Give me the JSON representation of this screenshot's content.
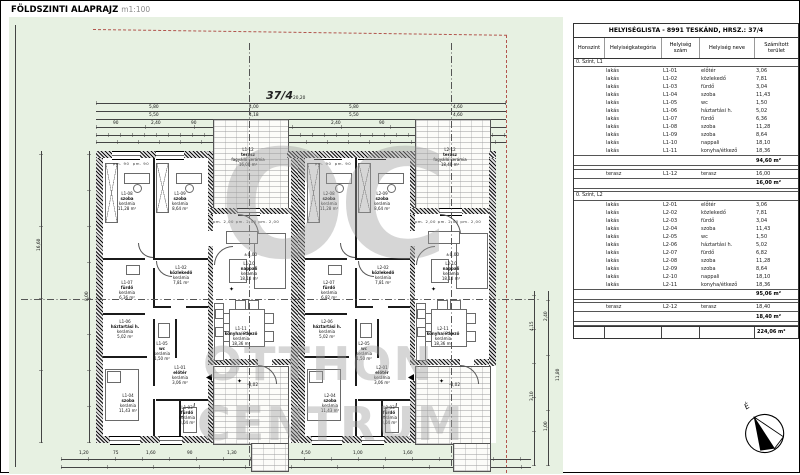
{
  "title": {
    "main": "FÖLDSZINTI ALAPRAJZ",
    "scale": "m1:100"
  },
  "site": {
    "parcel_label": "37/4",
    "north_label": "É",
    "level_zero": "±0,00",
    "level_minus": "-0,02",
    "window_head": "pm. 90",
    "door_head": "pm. 2,00  pm. 2,00  pm. 2,00",
    "colors": {
      "plot_green": "#e7f1e2",
      "boundary_red": "#b2554d"
    }
  },
  "watermark": {
    "initials": "OC",
    "line1": "OTTHON",
    "line2": "CENTRUM"
  },
  "dimensions": {
    "top_total": "20,20",
    "top_row2": [
      "5,80",
      "4,00",
      "5,80",
      "4,60"
    ],
    "top_row3": [
      "5,50",
      "4,18",
      "5,50",
      "4,60"
    ],
    "top_small": [
      "90",
      "2,40",
      "90",
      "2,40",
      "90",
      "1,20"
    ],
    "left": [
      "16,60",
      "8,00"
    ],
    "right": [
      "11,80",
      "4,15",
      "3,10",
      "2,40",
      "1,00"
    ],
    "bottom": [
      "1,20",
      "75",
      "1,60",
      "90",
      "1,30",
      "65",
      "4,50",
      "1,00",
      "1,60",
      "1,20"
    ]
  },
  "plan": {
    "rooms": {
      "L1-01": {
        "id": "L1-01",
        "name": "előtér",
        "finish": "kerámia",
        "area": "3,06 m²"
      },
      "L1-02": {
        "id": "L1-02",
        "name": "közlekedő",
        "finish": "kerámia",
        "area": "7,81 m²"
      },
      "L1-03": {
        "id": "L1-03",
        "name": "fürdő",
        "finish": "kerámia",
        "area": "3,04 m²"
      },
      "L1-04": {
        "id": "L1-04",
        "name": "szoba",
        "finish": "kerámia",
        "area": "11,43 m²"
      },
      "L1-05": {
        "id": "L1-05",
        "name": "wc",
        "finish": "kerámia",
        "area": "1,50 m²"
      },
      "L1-06": {
        "id": "L1-06",
        "name": "háztartási h.",
        "finish": "kerámia",
        "area": "5,02 m²"
      },
      "L1-07": {
        "id": "L1-07",
        "name": "fürdő",
        "finish": "kerámia",
        "area": "6,36 m²"
      },
      "L1-08": {
        "id": "L1-08",
        "name": "szoba",
        "finish": "kerámia",
        "area": "11,28 m²"
      },
      "L1-09": {
        "id": "L1-09",
        "name": "szoba",
        "finish": "kerámia",
        "area": "8,64 m²"
      },
      "L1-10": {
        "id": "L1-10",
        "name": "nappali",
        "finish": "kerámia",
        "area": "18,10 m²"
      },
      "L1-11": {
        "id": "L1-11",
        "name": "konyha/étkező",
        "finish": "kerámia",
        "area": "18,36 m²"
      },
      "L1-12": {
        "id": "L1-12",
        "name": "terasz",
        "finish": "fagyálló kerámia",
        "area": "16,00 m²"
      },
      "L2-01": {
        "id": "L2-01",
        "name": "előtér",
        "finish": "kerámia",
        "area": "3,06 m²"
      },
      "L2-02": {
        "id": "L2-02",
        "name": "közlekedő",
        "finish": "kerámia",
        "area": "7,81 m²"
      },
      "L2-03": {
        "id": "L2-03",
        "name": "fürdő",
        "finish": "kerámia",
        "area": "3,04 m²"
      },
      "L2-04": {
        "id": "L2-04",
        "name": "szoba",
        "finish": "kerámia",
        "area": "11,43 m²"
      },
      "L2-05": {
        "id": "L2-05",
        "name": "wc",
        "finish": "kerámia",
        "area": "1,50 m²"
      },
      "L2-06": {
        "id": "L2-06",
        "name": "háztartási h.",
        "finish": "kerámia",
        "area": "5,02 m²"
      },
      "L2-07": {
        "id": "L2-07",
        "name": "fürdő",
        "finish": "kerámia",
        "area": "6,82 m²"
      },
      "L2-08": {
        "id": "L2-08",
        "name": "szoba",
        "finish": "kerámia",
        "area": "11,28 m²"
      },
      "L2-09": {
        "id": "L2-09",
        "name": "szoba",
        "finish": "kerámia",
        "area": "8,64 m²"
      },
      "L2-10": {
        "id": "L2-10",
        "name": "nappali",
        "finish": "kerámia",
        "area": "18,10 m²"
      },
      "L2-11": {
        "id": "L2-11",
        "name": "konyha/étkező",
        "finish": "kerámia",
        "area": "18,36 m²"
      },
      "L2-12": {
        "id": "L2-12",
        "name": "terasz",
        "finish": "fagyálló kerámia",
        "area": "18,40 m²"
      }
    }
  },
  "table": {
    "title": "HELYISÉGLISTA - 8991 TESKÁND, HRSZ.: 37/4",
    "columns": [
      "Honszint",
      "Helyiségkategória",
      "Helyiség szám",
      "Helyiség neve",
      "Számított terület"
    ],
    "groups": [
      {
        "label": "0. Szint, L1",
        "rows": [
          [
            "lakás",
            "L1-01",
            "előtér",
            "3,06"
          ],
          [
            "lakás",
            "L1-02",
            "közlekedő",
            "7,81"
          ],
          [
            "lakás",
            "L1-03",
            "fürdő",
            "3,04"
          ],
          [
            "lakás",
            "L1-04",
            "szoba",
            "11,43"
          ],
          [
            "lakás",
            "L1-05",
            "wc",
            "1,50"
          ],
          [
            "lakás",
            "L1-06",
            "háztartási h.",
            "5,02"
          ],
          [
            "lakás",
            "L1-07",
            "fürdő",
            "6,36"
          ],
          [
            "lakás",
            "L1-08",
            "szoba",
            "11,28"
          ],
          [
            "lakás",
            "L1-09",
            "szoba",
            "8,64"
          ],
          [
            "lakás",
            "L1-10",
            "nappali",
            "18,10"
          ],
          [
            "lakás",
            "L1-11",
            "konyha/étkező",
            "18,36"
          ]
        ],
        "subtotal": "94,60 m²",
        "terrace_rows": [
          [
            "terasz",
            "L1-12",
            "terasz",
            "16,00"
          ]
        ],
        "terrace_subtotal": "16,00 m²"
      },
      {
        "label": "0. Szint, L2",
        "rows": [
          [
            "lakás",
            "L2-01",
            "előtér",
            "3,06"
          ],
          [
            "lakás",
            "L2-02",
            "közlekedő",
            "7,81"
          ],
          [
            "lakás",
            "L2-03",
            "fürdő",
            "3,04"
          ],
          [
            "lakás",
            "L2-04",
            "szoba",
            "11,43"
          ],
          [
            "lakás",
            "L2-05",
            "wc",
            "1,50"
          ],
          [
            "lakás",
            "L2-06",
            "háztartási h.",
            "5,02"
          ],
          [
            "lakás",
            "L2-07",
            "fürdő",
            "6,82"
          ],
          [
            "lakás",
            "L2-08",
            "szoba",
            "11,28"
          ],
          [
            "lakás",
            "L2-09",
            "szoba",
            "8,64"
          ],
          [
            "lakás",
            "L2-10",
            "nappali",
            "18,10"
          ],
          [
            "lakás",
            "L2-11",
            "konyha/étkező",
            "18,36"
          ]
        ],
        "subtotal": "95,06 m²",
        "terrace_rows": [
          [
            "terasz",
            "L2-12",
            "terasz",
            "18,40"
          ]
        ],
        "terrace_subtotal": "18,40 m²"
      }
    ],
    "grand_total": "224,06 m²"
  }
}
